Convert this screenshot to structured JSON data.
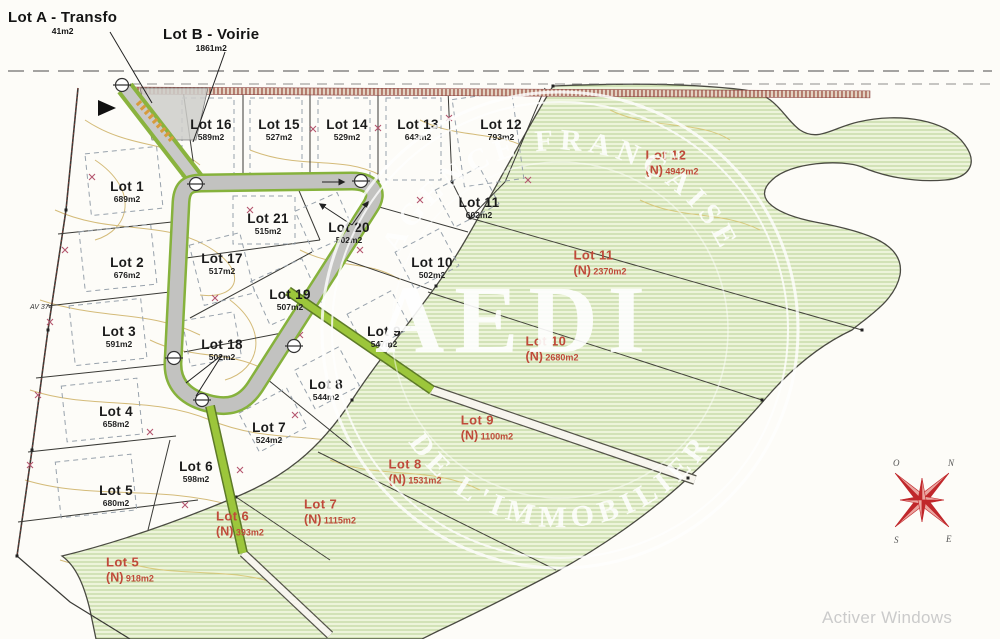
{
  "header": {
    "lot_a": {
      "name": "Lot A - Transfo",
      "area": "41m2"
    },
    "lot_b": {
      "name": "Lot B - Voirie",
      "area": "1861m2"
    }
  },
  "black_lots": [
    {
      "name": "Lot 16",
      "area": "589m2",
      "x": 211,
      "y": 130
    },
    {
      "name": "Lot 15",
      "area": "527m2",
      "x": 279,
      "y": 130
    },
    {
      "name": "Lot 14",
      "area": "529m2",
      "x": 347,
      "y": 130
    },
    {
      "name": "Lot 13",
      "area": "643m2",
      "x": 418,
      "y": 130
    },
    {
      "name": "Lot 12",
      "area": "793m2",
      "x": 501,
      "y": 130
    },
    {
      "name": "Lot 1",
      "area": "689m2",
      "x": 127,
      "y": 192
    },
    {
      "name": "Lot 21",
      "area": "515m2",
      "x": 268,
      "y": 224
    },
    {
      "name": "Lot 20",
      "area": "502m2",
      "x": 349,
      "y": 233
    },
    {
      "name": "Lot 11",
      "area": "602m2",
      "x": 479,
      "y": 208
    },
    {
      "name": "Lot 17",
      "area": "517m2",
      "x": 222,
      "y": 264
    },
    {
      "name": "Lot 2",
      "area": "676m2",
      "x": 127,
      "y": 268
    },
    {
      "name": "Lot 10",
      "area": "502m2",
      "x": 432,
      "y": 268
    },
    {
      "name": "Lot 19",
      "area": "507m2",
      "x": 290,
      "y": 300
    },
    {
      "name": "Lot 3",
      "area": "591m2",
      "x": 119,
      "y": 337
    },
    {
      "name": "Lot 9",
      "area": "547m2",
      "x": 384,
      "y": 337
    },
    {
      "name": "Lot 18",
      "area": "502m2",
      "x": 222,
      "y": 350
    },
    {
      "name": "Lot 8",
      "area": "544m2",
      "x": 326,
      "y": 390
    },
    {
      "name": "Lot 4",
      "area": "658m2",
      "x": 116,
      "y": 417
    },
    {
      "name": "Lot 7",
      "area": "524m2",
      "x": 269,
      "y": 433
    },
    {
      "name": "Lot 6",
      "area": "598m2",
      "x": 196,
      "y": 472
    },
    {
      "name": "Lot 5",
      "area": "680m2",
      "x": 116,
      "y": 496
    }
  ],
  "red_lots": [
    {
      "name": "Lot 12",
      "n": "(N)",
      "area": "4942m2",
      "x": 672,
      "y": 163
    },
    {
      "name": "Lot 11",
      "n": "(N)",
      "area": "2370m2",
      "x": 600,
      "y": 263
    },
    {
      "name": "Lot 10",
      "n": "(N)",
      "area": "2680m2",
      "x": 552,
      "y": 349
    },
    {
      "name": "Lot 9",
      "n": "(N)",
      "area": "1100m2",
      "x": 487,
      "y": 428
    },
    {
      "name": "Lot 8",
      "n": "(N)",
      "area": "1531m2",
      "x": 415,
      "y": 472
    },
    {
      "name": "Lot 7",
      "n": "(N)",
      "area": "1115m2",
      "x": 330,
      "y": 512
    },
    {
      "name": "Lot 6",
      "n": "(N)",
      "area": "393m2",
      "x": 240,
      "y": 524
    },
    {
      "name": "Lot 5",
      "n": "(N)",
      "area": "918m2",
      "x": 130,
      "y": 570
    }
  ],
  "watermark": {
    "brand": "AEDI",
    "arc_top": "AGENCE FRANÇAISE",
    "arc_bottom": "DE L'IMMOBILIER",
    "tm": "™"
  },
  "compass": {
    "n": "N",
    "e": "E",
    "s": "S",
    "o": "O"
  },
  "road_label": "AV 374",
  "os_overlay": "Activer Windows"
}
